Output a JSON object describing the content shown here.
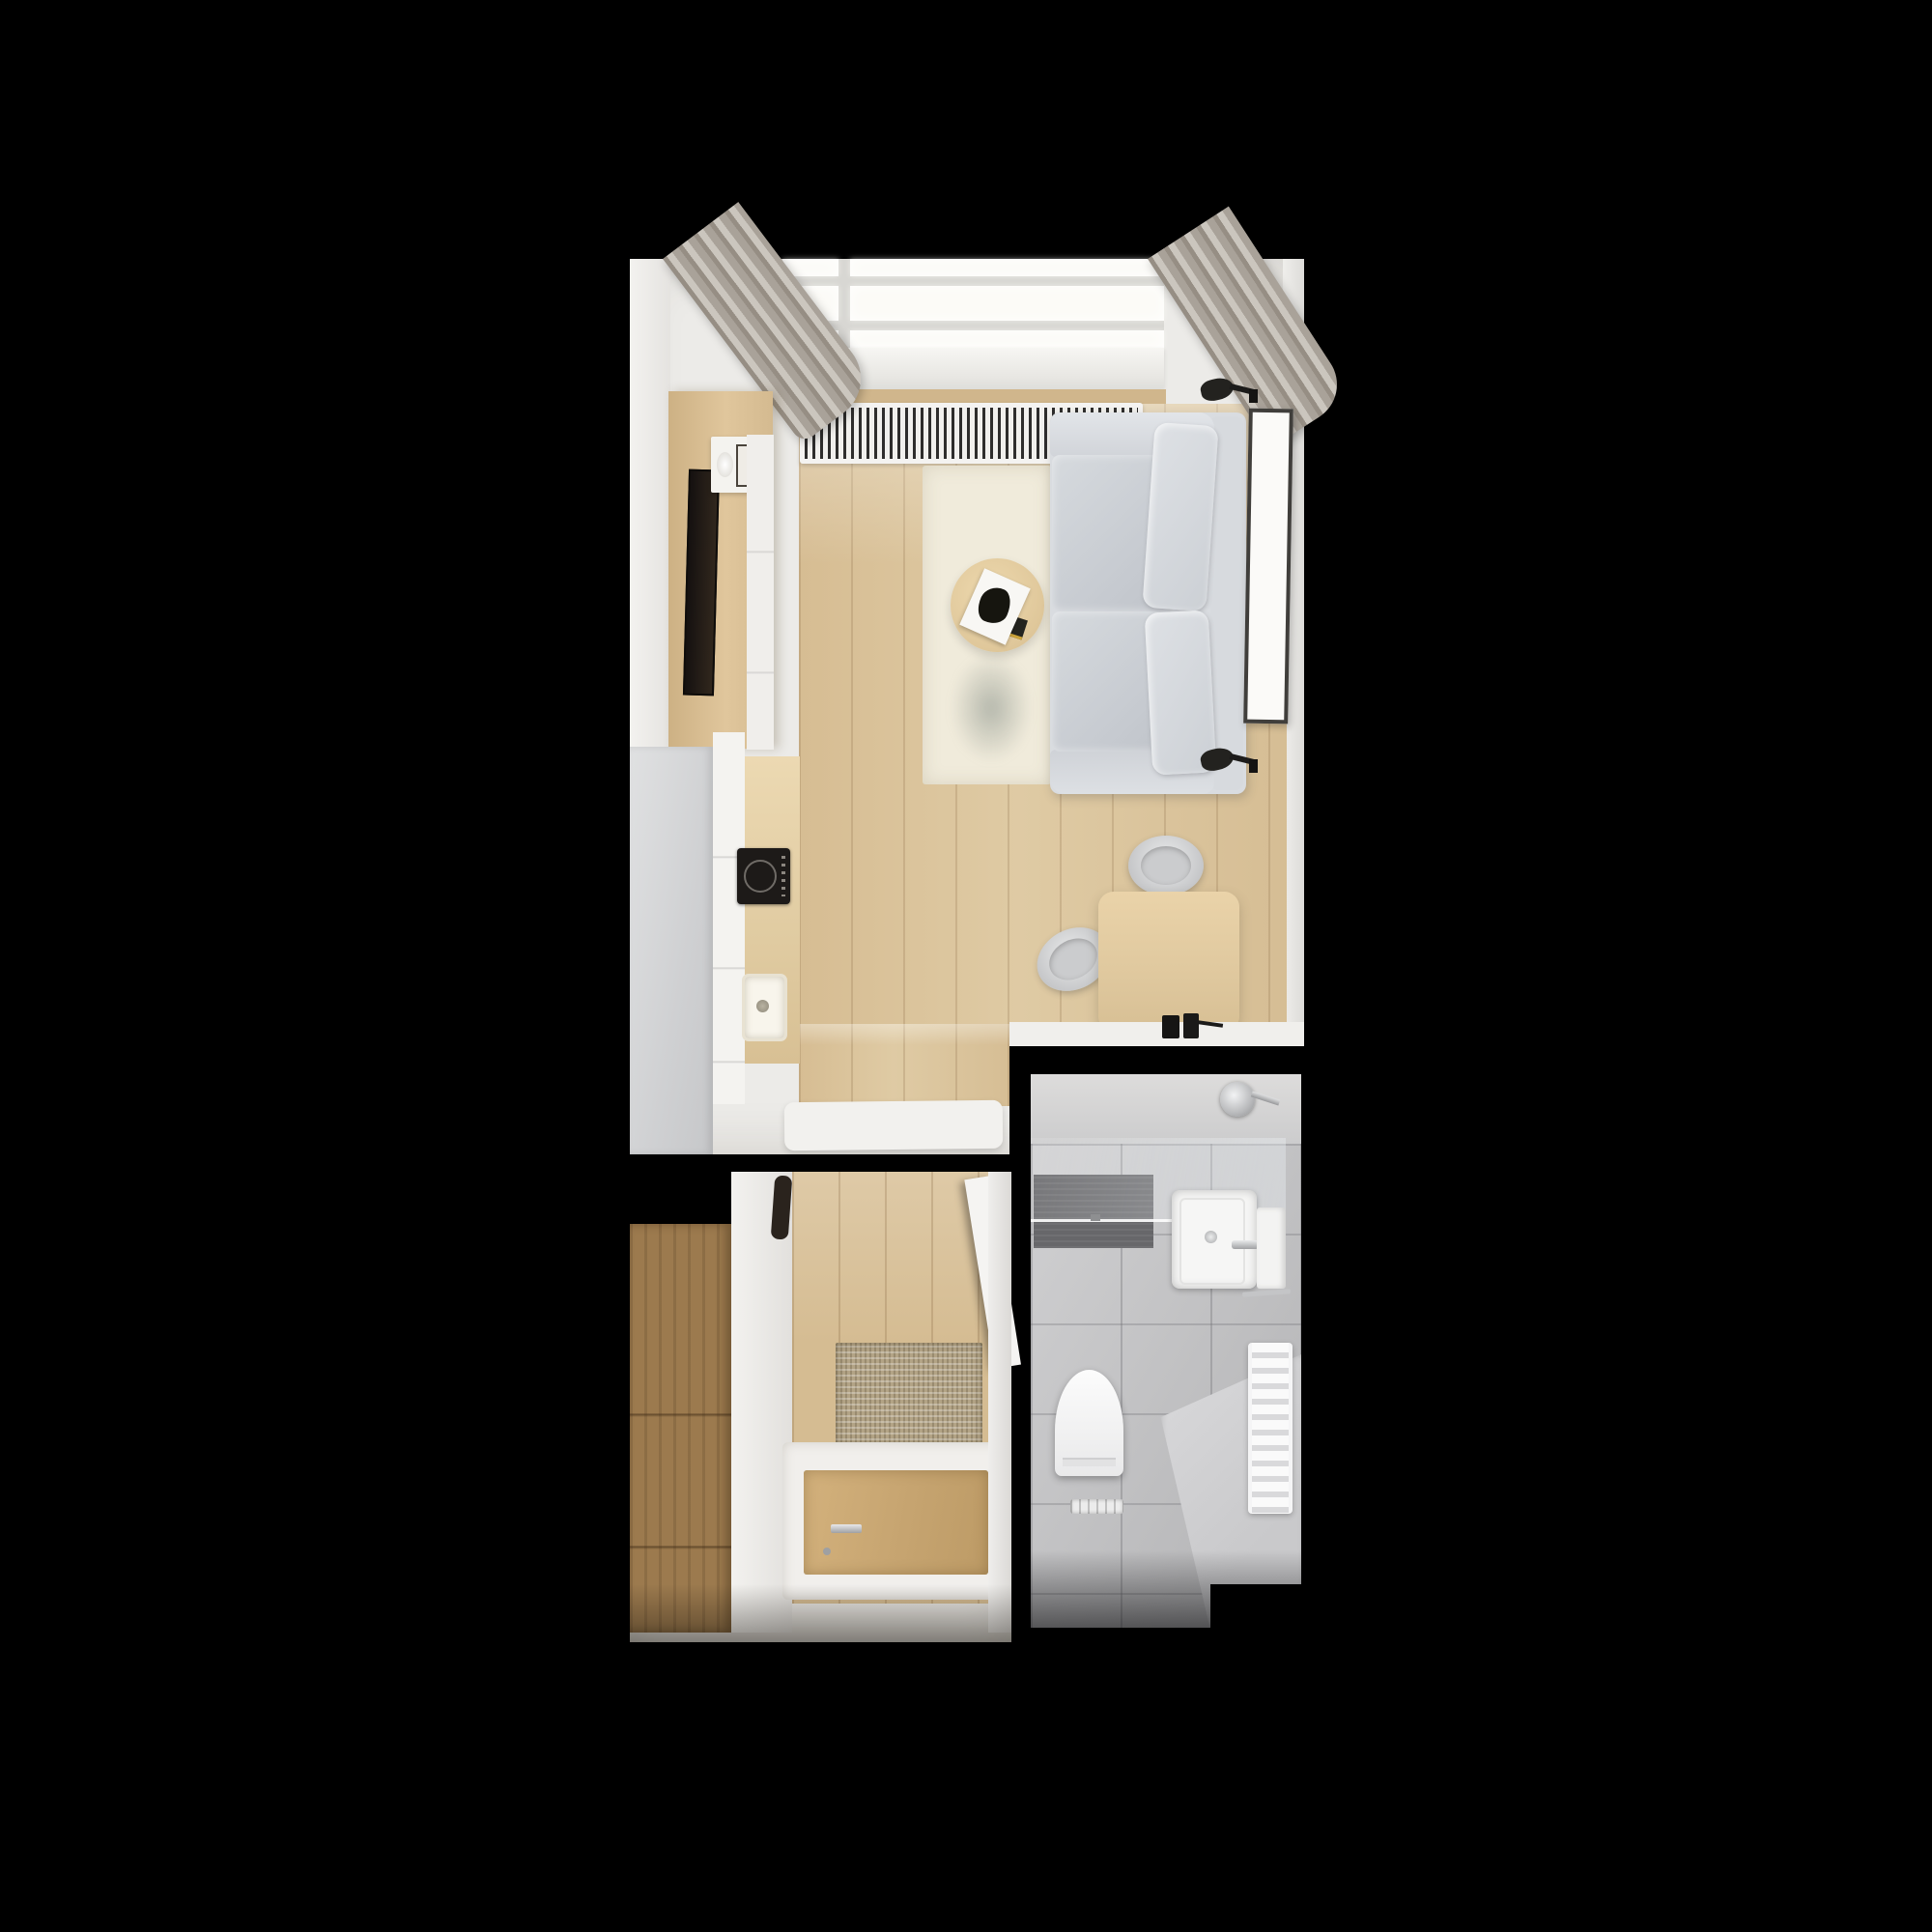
{
  "scene": {
    "title": "studio-apartment-top-down-render",
    "background": "#000000",
    "colors": {
      "wall_white": "#ecebe8",
      "floor_wood": "#dcc7a0",
      "floor_wood_hall": "#d5bc92",
      "panel_wood": "#d9bd93",
      "counter_wood": "#e3cfa8",
      "desk_wood": "#e2caa0",
      "wardrobe_wood": "#9c7a4e",
      "door_wood": "#c9a872",
      "rug_cream": "#f0ebdb",
      "doormat_beige": "#b3a486",
      "sofa_frame": "#d9dce0",
      "sofa_cushion": "#cdd1d7",
      "sofa_pillow": "#d7dade",
      "chair_gray": "#cfd0d2",
      "curtain_gray": "#b2aca4",
      "radiator_white": "#f4f3f1",
      "radiator_slats": "#2e2d2c",
      "cooktop_black": "#1d1a18",
      "tv_black": "#241d17",
      "accent_black": "#1f1e1d",
      "tile_gray": "#c6c6c8",
      "tile_dark": "#67676a",
      "platform_gray": "#d4d4d6",
      "fixture_white": "#f6f6f5",
      "chrome": "#b9babc",
      "window_glow": "#fcfbf7"
    },
    "rooms": [
      {
        "name": "living-room-with-kitchenette",
        "objects": [
          "skylight-window",
          "window-sill",
          "curtain-left",
          "curtain-right",
          "radiator",
          "tv-wall-panel",
          "tv",
          "decor-shelf",
          "vase",
          "shelf-picture",
          "white-cabinet-column",
          "fridge-cabinet",
          "kitchen-counter-white",
          "kitchen-counter-wood",
          "induction-cooktop",
          "kitchen-sink",
          "area-rug",
          "coffee-table",
          "magazine",
          "book",
          "sofa",
          "seat-cushions",
          "back-pillows",
          "wall-lamp-top",
          "wall-lamp-bottom",
          "picture-frame",
          "desk",
          "desk-chair-top",
          "desk-chair-left",
          "desk-lamp",
          "threshold-bench"
        ]
      },
      {
        "name": "entry-hallway",
        "objects": [
          "wardrobe",
          "wardrobe-side-panel",
          "mirror",
          "doormat",
          "entry-door-frame",
          "entry-door-leaf",
          "door-handle",
          "open-door-leaf"
        ]
      },
      {
        "name": "bathroom",
        "objects": [
          "shower-mixer",
          "shower-glass-screen",
          "dark-shower-tiles",
          "sink-vanity",
          "faucet",
          "vanity-knob",
          "side-cabinet",
          "towel-radiator",
          "towel-bar",
          "toilet",
          "linear-floor-drain",
          "raised-floor-platform"
        ]
      }
    ]
  }
}
